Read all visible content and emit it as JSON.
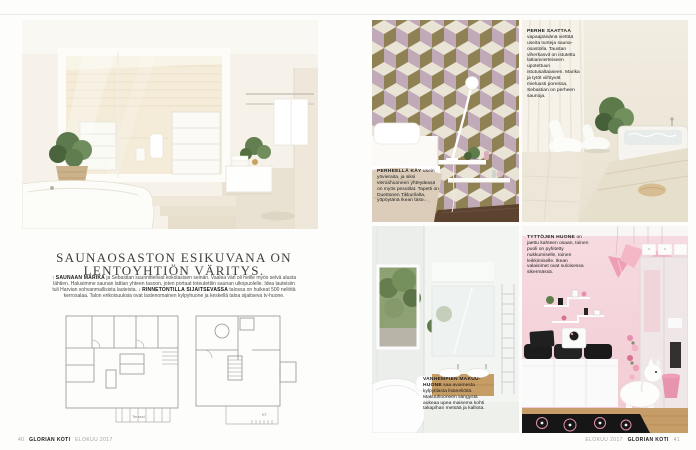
{
  "left_page": {
    "headline": {
      "line1": "SAUNAOSASTON ESIKUVANA ON",
      "line2": "LENTOYHTIÖN VÄRITYS."
    },
    "intro": {
      "arrow_up": "↑",
      "lead1": "SAUNAAN MARIKA",
      "text1": "ja Sebastian suunnittelivat kokolasisen seinän. Vaalea väri oli heille myös selvä alusta lähtien. Halusimme saunan lattian yhteen tasoon, joten portaat toteutettiin saunan ulkopuolelle. Idea lauteisiin tuli Harvian sohvanmallisista lauteista.",
      "arrow_down": "↓",
      "lead2": "RINNETONTILLA SIJAITSEVASSA",
      "text2": "talossa on huikeat 500 neliötä kerrosalaa. Talon erikoisuuksia ovat lastenomainen kylpyhuone ja keskellä taloa sijaitseva tv-huone."
    },
    "floorplans": {
      "left_label": "Terassi",
      "right_label": "KT"
    },
    "footer": {
      "page_number": "40",
      "brand": "GLORIAN KOTI",
      "issue": "ELOKUU 2017"
    }
  },
  "right_page": {
    "captions": {
      "spa": {
        "lead": "PERHE SAATTAA",
        "text": "vapaapäivänä viettää useita tunteja sauna­osastolla. Taustan viherkasvit on istutettu lattianvierteiseen upotettuun istutusaltaaseen. Marika ja tytöt viihtyvät mieluusti poreissa, Sebastian on perheen saunoja."
      },
      "bedroom": {
        "lead": "PERHEELLÄ KÄY",
        "text": "usein yövieraita, ja siksi vierashuoneen yhteydessä on myös pesutilat. Tapetti on Duettonen Tikkurilalta, yöpöytänä Ikean taso."
      },
      "girls": {
        "lead": "TYTTÖJEN HUONE",
        "text": "on jaettu kahteen osaan, toinen puoli on pyhitetty nukkumiselle, toinen leikkimiselle. Ikean valaisimet ovat suloisessa sikermässä."
      },
      "master": {
        "lead": "VANHEMPIEN MAKUU­HUONE",
        "text": "saa avoimesta kylpytilasta lisäneliöitä. Makuuhuoneen sängystä aukeaa upea maisema kohti takapihan metsää ja kalliota."
      }
    },
    "footer": {
      "issue": "ELOKUU 2017",
      "brand": "GLORIAN KOTI",
      "page_number": "41"
    }
  },
  "colors": {
    "wallpaper_cream": "#eae4d7",
    "wallpaper_mauve": "#c0aab8",
    "wallpaper_olive": "#8f8153",
    "pink_wall_top": "#f6dbe0",
    "pink_wall_bottom": "#f2ccd4",
    "accent_pink": "#ef9fb4",
    "headline_gray": "#3e3e3e"
  }
}
